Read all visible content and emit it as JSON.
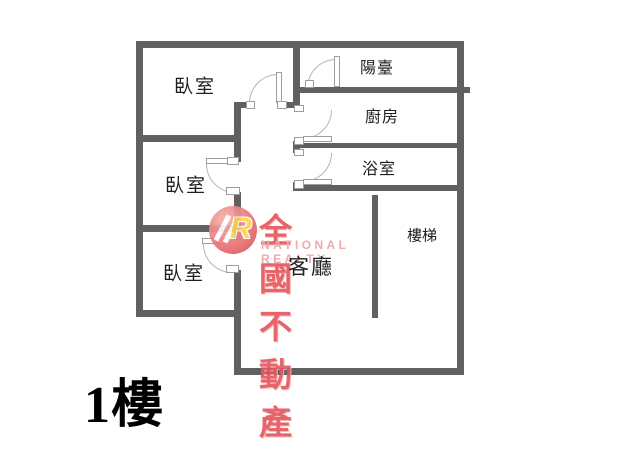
{
  "floor_label": "1樓",
  "rooms": {
    "bedroom_top": "臥室",
    "bedroom_middle": "臥室",
    "bedroom_bottom": "臥室",
    "balcony": "陽臺",
    "kitchen": "廚房",
    "bathroom": "浴室",
    "living_room": "客廳",
    "stairs": "樓梯"
  },
  "watermark": {
    "logo_letter": "R",
    "title": "全國不動產",
    "subtitle": "NATIONAL REALTY"
  },
  "colors": {
    "wall": "#606060",
    "door_stroke": "#b5b5b5",
    "jamb_stroke": "#9e9e9e",
    "label": "#1f1f1f",
    "floor_label": "#000000",
    "watermark_title": "#e4575e",
    "watermark_subtitle": "#eea3a8",
    "logo_circle_inner": "#f7b5ae",
    "logo_circle_outer": "#e25f66",
    "logo_letter": "#ffd24d",
    "background": "#ffffff"
  }
}
